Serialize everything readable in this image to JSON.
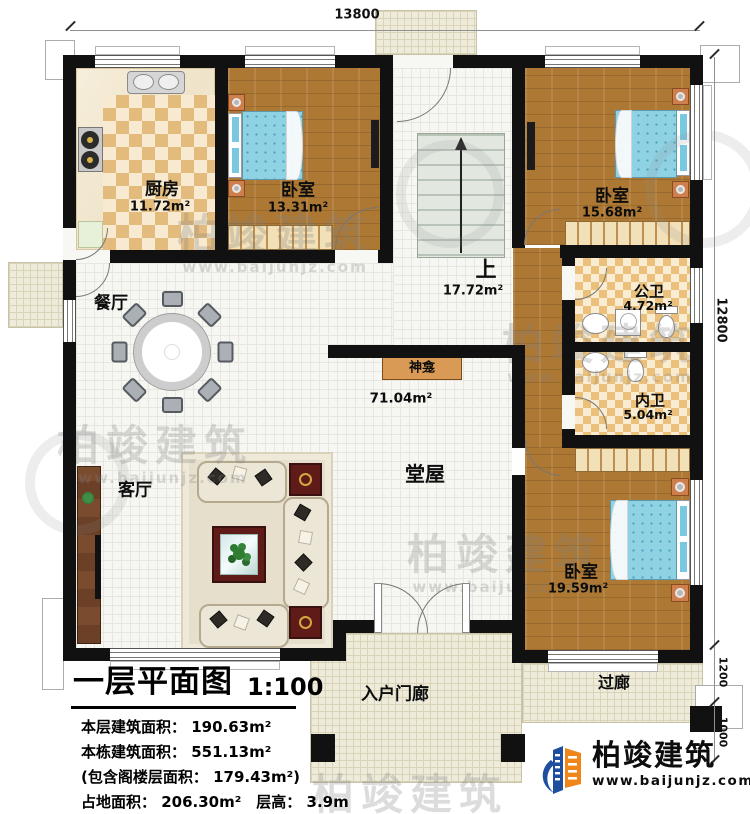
{
  "dim": {
    "top": "13800",
    "right": "12800",
    "porch": "1200",
    "step": "1000"
  },
  "rooms": {
    "kitchen": {
      "name": "厨房",
      "area": "11.72m²"
    },
    "bedroom1": {
      "name": "卧室",
      "area": "13.31m²"
    },
    "stairs": {
      "name": "上",
      "area": "17.72m²"
    },
    "bedroom2": {
      "name": "卧室",
      "area": "15.68m²"
    },
    "public_bath": {
      "name": "公卫",
      "area": "4.72m²"
    },
    "private_bath": {
      "name": "内卫",
      "area": "5.04m²"
    },
    "bedroom3": {
      "name": "卧室",
      "area": "19.59m²"
    },
    "dining": {
      "name": "餐厅"
    },
    "living": {
      "name": "客厅"
    },
    "hall": {
      "name": "堂屋",
      "area": "71.04m²"
    },
    "shrine": {
      "name": "神龛"
    },
    "porch": {
      "name": "入户门廊"
    },
    "corridor": {
      "name": "过廊"
    }
  },
  "title_block": {
    "title": "一层平面图",
    "scale": "1:100",
    "lines": [
      "本层建筑面积： 190.63m²",
      "本栋建筑面积： 551.13m²",
      "(包含阁楼层面积： 179.43m²)",
      "占地面积： 206.30m²　层高： 3.9m"
    ]
  },
  "brand": {
    "name": "柏竣建筑",
    "url": "www.baijunjz.com",
    "colors": {
      "blue": "#1d4f9e",
      "orange": "#f08519",
      "text": "#111111"
    }
  },
  "watermark": {
    "name": "柏竣建筑",
    "url": "www.baijunjz.com"
  }
}
